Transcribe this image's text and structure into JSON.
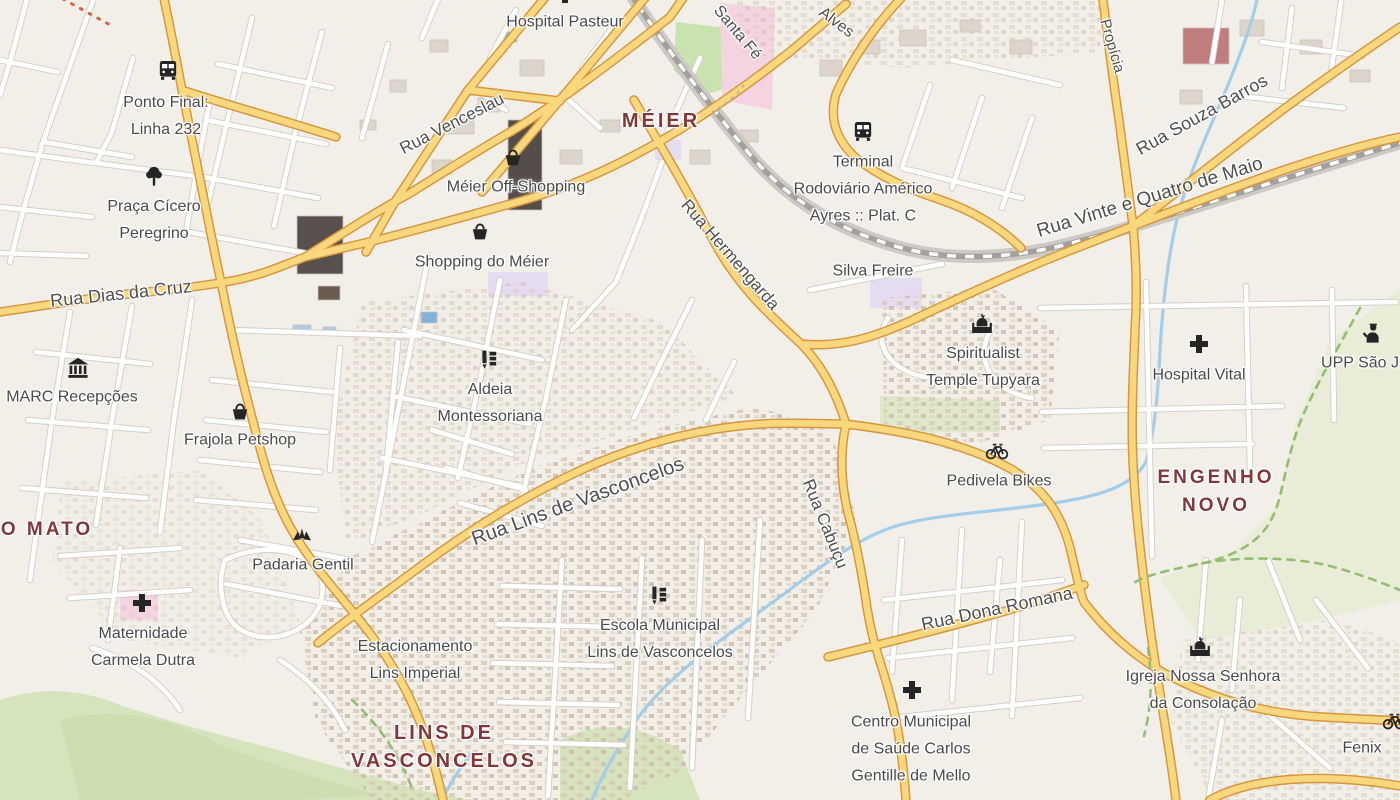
{
  "map": {
    "colors": {
      "background": "#f2efe9",
      "road_primary_fill": "#f8d77d",
      "road_primary_casing": "#d6953f",
      "road_minor_fill": "#ffffff",
      "road_minor_casing": "#d4cfc6",
      "water": "#a4cde9",
      "park_green": "#c9e3ae",
      "hill_green": "#d6e4bd",
      "hospital_pink": "#f6d3e0",
      "railway_gray": "#a3a09d",
      "neighborhood_text": "#823838",
      "street_text": "#4f4f4f",
      "poi_text": "#4a4a4a",
      "icon_black": "#252525",
      "boundary_dash_green": "#93bd72"
    },
    "neighborhoods": [
      {
        "lines": [
          "MÉIER"
        ],
        "x": 661,
        "y": 121,
        "size": 20
      },
      {
        "lines": [
          "ENGENHO",
          "NOVO"
        ],
        "x": 1216,
        "y": 492,
        "size": 19
      },
      {
        "lines": [
          "O MATO"
        ],
        "x": 47,
        "y": 530,
        "size": 19
      },
      {
        "lines": [
          "LINS DE",
          "VASCONCELOS"
        ],
        "x": 444,
        "y": 747,
        "size": 20
      }
    ],
    "streets": [
      {
        "text": "Santa Fé",
        "x": 737,
        "y": 33,
        "rot": 50,
        "size": 16
      },
      {
        "text": "Alves",
        "x": 836,
        "y": 23,
        "rot": 37,
        "size": 16
      },
      {
        "text": "Rua Venceslau",
        "x": 452,
        "y": 124,
        "rot": -27,
        "size": 17
      },
      {
        "text": "Rua Hermengarda",
        "x": 730,
        "y": 255,
        "rot": 49,
        "size": 17
      },
      {
        "text": "Rua Dias da Cruz",
        "x": 121,
        "y": 294,
        "rot": -6,
        "size": 18
      },
      {
        "text": "Rua Souza Barros",
        "x": 1202,
        "y": 115,
        "rot": -29,
        "size": 18
      },
      {
        "text": "Propícia",
        "x": 1112,
        "y": 46,
        "rot": 74,
        "size": 15
      },
      {
        "text": "Rua Vinte e Quatro de Maio",
        "x": 1150,
        "y": 198,
        "rot": -17,
        "size": 19
      },
      {
        "text": "Rua Lins de Vasconcelos",
        "x": 578,
        "y": 502,
        "rot": -20,
        "size": 20
      },
      {
        "text": "Rua Cabuçu",
        "x": 825,
        "y": 524,
        "rot": 68,
        "size": 17
      },
      {
        "text": "Rua Dona Romana",
        "x": 997,
        "y": 609,
        "rot": -12,
        "size": 18
      }
    ],
    "pois": [
      {
        "icon": "cross",
        "ix": 565,
        "iy": -6,
        "lines": [
          "Hospital Pasteur"
        ],
        "tx": 565,
        "ty": 22
      },
      {
        "icon": "bus",
        "ix": 168,
        "iy": 70,
        "lines": [
          "Ponto Final:",
          "Linha 232"
        ],
        "tx": 166,
        "ty": 116
      },
      {
        "icon": "tree",
        "ix": 154,
        "iy": 176,
        "lines": [
          "Praça Cícero",
          "Peregrino"
        ],
        "tx": 154,
        "ty": 220
      },
      {
        "icon": "basket",
        "ix": 513,
        "iy": 157,
        "lines": [
          "Méier Off-Shopping"
        ],
        "tx": 516,
        "ty": 187
      },
      {
        "icon": "basket",
        "ix": 480,
        "iy": 231,
        "lines": [
          "Shopping do Méier"
        ],
        "tx": 482,
        "ty": 262
      },
      {
        "icon": "bus",
        "ix": 863,
        "iy": 131,
        "lines": [
          "Terminal",
          "Rodoviário Américo",
          "Ayres :: Plat. C"
        ],
        "tx": 863,
        "ty": 189
      },
      {
        "icon": null,
        "lines": [
          "Silva Freire"
        ],
        "tx": 873,
        "ty": 271
      },
      {
        "icon": "museum",
        "ix": 78,
        "iy": 368,
        "lines": [
          "MARC Recepções"
        ],
        "tx": 72,
        "ty": 397
      },
      {
        "icon": "basket",
        "ix": 240,
        "iy": 411,
        "lines": [
          "Frajola Petshop"
        ],
        "tx": 240,
        "ty": 440
      },
      {
        "icon": "school",
        "ix": 489,
        "iy": 359,
        "lines": [
          "Aldeia",
          "Montessoriana"
        ],
        "tx": 490,
        "ty": 403
      },
      {
        "icon": "temple",
        "ix": 982,
        "iy": 324,
        "lines": [
          "Spiritualist",
          "Temple Tupyara"
        ],
        "tx": 983,
        "ty": 367
      },
      {
        "icon": "cross",
        "ix": 1199,
        "iy": 344,
        "lines": [
          "Hospital Vital"
        ],
        "tx": 1199,
        "ty": 375
      },
      {
        "icon": "police",
        "ix": 1372,
        "iy": 333,
        "lines": [
          "UPP São J"
        ],
        "tx": 1360,
        "ty": 363
      },
      {
        "icon": "bicycle",
        "ix": 997,
        "iy": 450,
        "lines": [
          "Pedivela Bikes"
        ],
        "tx": 999,
        "ty": 481
      },
      {
        "icon": "bakery",
        "ix": 302,
        "iy": 535,
        "lines": [
          "Padaria Gentil"
        ],
        "tx": 303,
        "ty": 565
      },
      {
        "icon": "cross",
        "ix": 142,
        "iy": 603,
        "lines": [
          "Maternidade",
          "Carmela Dutra"
        ],
        "tx": 143,
        "ty": 647
      },
      {
        "icon": null,
        "lines": [
          "Estacionamento",
          "Lins Imperial"
        ],
        "tx": 415,
        "ty": 660
      },
      {
        "icon": "school",
        "ix": 659,
        "iy": 595,
        "lines": [
          "Escola Municipal",
          "Lins de Vasconcelos"
        ],
        "tx": 660,
        "ty": 639
      },
      {
        "icon": "cross",
        "ix": 912,
        "iy": 690,
        "lines": [
          "Centro Municipal",
          "de Saúde Carlos",
          "Gentille de Mello"
        ],
        "tx": 911,
        "ty": 749
      },
      {
        "icon": "temple",
        "ix": 1200,
        "iy": 647,
        "lines": [
          "Igreja Nossa Senhora",
          "da Consolação"
        ],
        "tx": 1203,
        "ty": 690
      },
      {
        "icon": null,
        "lines": [
          "Fenix"
        ],
        "tx": 1362,
        "ty": 748
      },
      {
        "icon": "bicycle",
        "ix": 1394,
        "iy": 720,
        "lines": [],
        "tx": 1394,
        "ty": 720
      }
    ]
  }
}
